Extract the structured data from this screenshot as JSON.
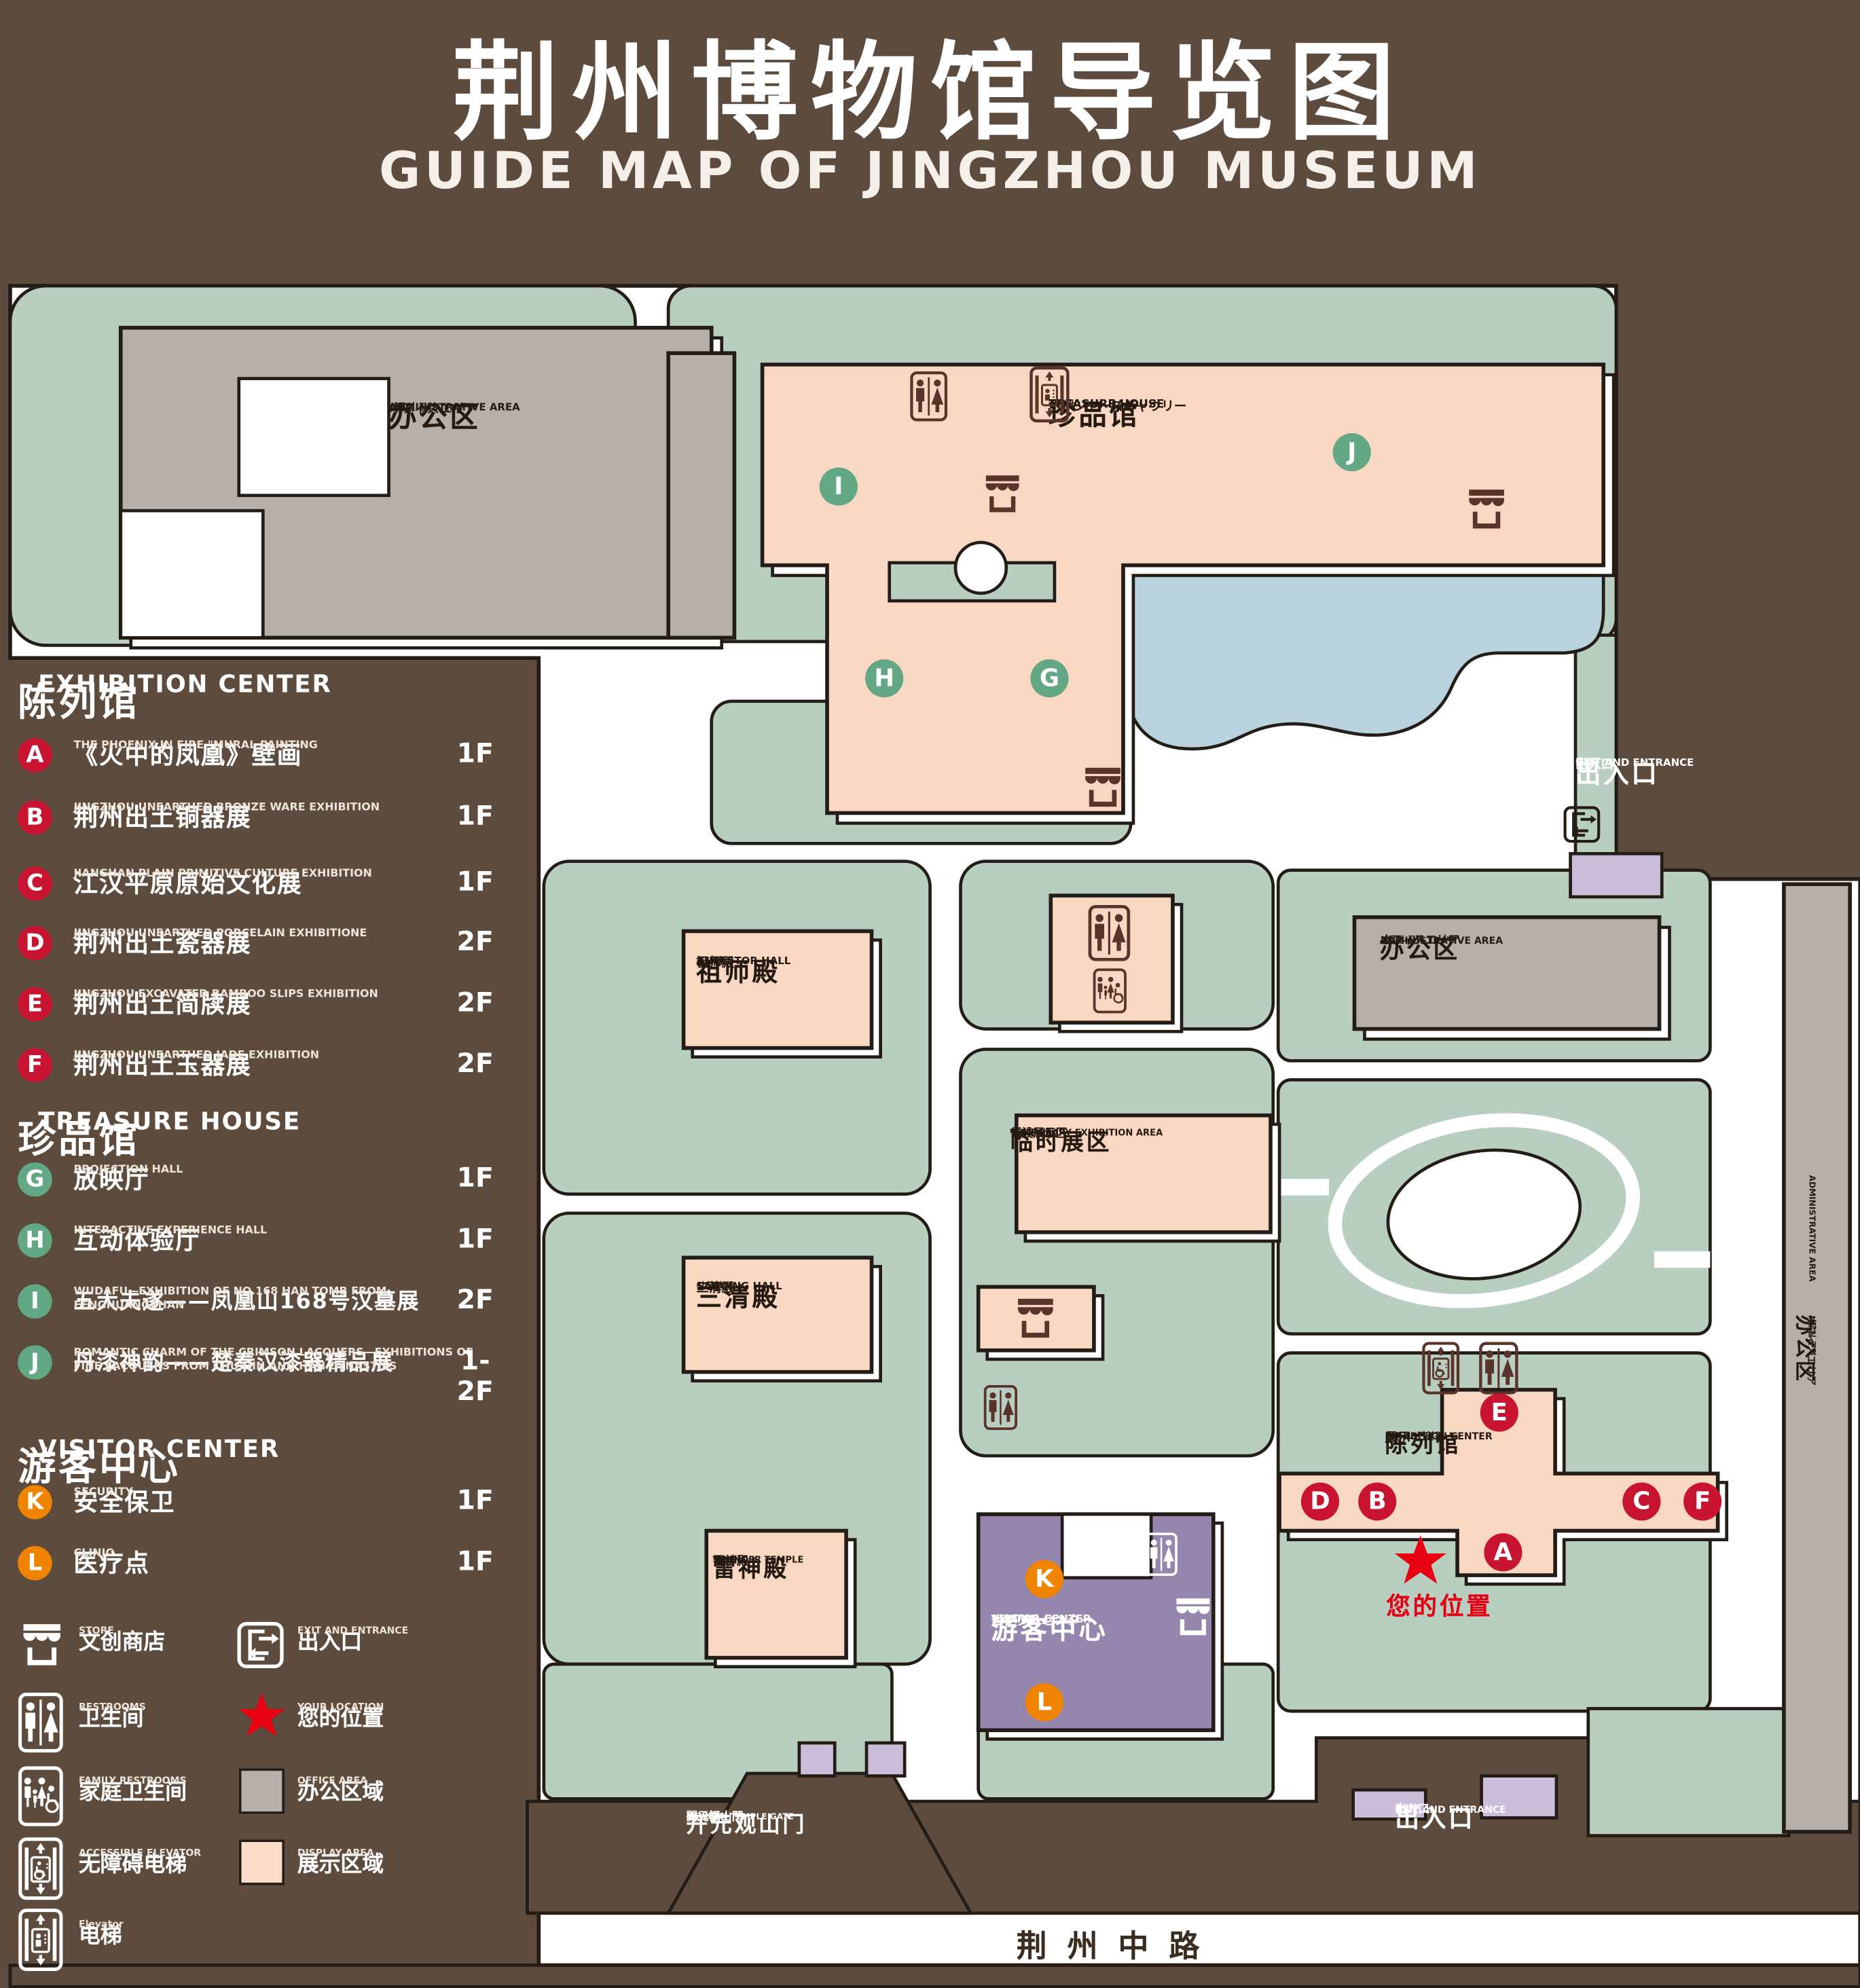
{
  "title": {
    "zh": "荆州博物馆导览图",
    "en": "GUIDE MAP OF JINGZHOU MUSEUM"
  },
  "legend": {
    "sections": [
      {
        "zh": "陈列馆",
        "en": "EXHIBITION CENTER",
        "items": [
          {
            "letter": "A",
            "title": "《火中的凤凰》壁画",
            "sub": "THE PHOENIX IN FIRE \"MURAL PAINTING",
            "floor": "1F"
          },
          {
            "letter": "B",
            "title": "荆州出土铜器展",
            "sub": "JINGZHOU UNEARTHED BRONZE WARE EXHIBITION",
            "floor": "1F"
          },
          {
            "letter": "C",
            "title": "江汉平原原始文化展",
            "sub": "JIANGHAN PLAIN PRIMITIVE CULTURE EXHIBITION",
            "floor": "1F"
          },
          {
            "letter": "D",
            "title": "荆州出土瓷器展",
            "sub": "JINGZHOU UNEARTHED PORCELAIN EXHIBITIONE",
            "floor": "2F"
          },
          {
            "letter": "E",
            "title": "荆州出土简牍展",
            "sub": "JINGZHOU EXCAVATED BAMBOO SLIPS EXHIBITION",
            "floor": "2F"
          },
          {
            "letter": "F",
            "title": "荆州出土玉器展",
            "sub": "JINGZHOU UNEARTHED JADE EXHIBITION",
            "floor": "2F"
          }
        ]
      },
      {
        "zh": "珍品馆",
        "en": "TREASURE HOUSE",
        "items": [
          {
            "letter": "G",
            "title": "放映厅",
            "sub": "PROJECTION HALL",
            "floor": "1F"
          },
          {
            "letter": "H",
            "title": "互动体验厅",
            "sub": "INTERACTIVE EXPERIENCE HALL",
            "floor": "1F"
          },
          {
            "letter": "I",
            "title": "五大夫遂——凤凰山168号汉墓展",
            "sub": "WUDAFU—EXHIBITION OF NO.168 HAN TOMB FROM FENGHUANGSHAN",
            "floor": "2F"
          },
          {
            "letter": "J",
            "title": "丹漆神韵——楚秦汉漆器精品展",
            "sub": "ROMANTIC CHARM OF THE CRIMSON LACQUERS—EXHIBITIONS OF FINE LACQUERS FROM CHU,QIN AND HAN DYNASTIES",
            "floor": "1-2F"
          }
        ]
      },
      {
        "zh": "游客中心",
        "en": "VISITOR CENTER",
        "items": [
          {
            "letter": "K",
            "title": "安全保卫",
            "sub": "SECURITY",
            "floor": "1F"
          },
          {
            "letter": "L",
            "title": "医疗点",
            "sub": "CLINIC",
            "floor": "1F"
          }
        ]
      }
    ],
    "symbols": [
      {
        "zh": "文创商店",
        "en": "STORE"
      },
      {
        "zh": "出入口",
        "en": "EXIT AND ENTRANCE"
      },
      {
        "zh": "卫生间",
        "en": "RESTROOMS"
      },
      {
        "zh": "您的位置",
        "en": "YOUR LOCATION"
      },
      {
        "zh": "家庭卫生间",
        "en": "FAMILY RESTROOMS"
      },
      {
        "zh": "办公区域",
        "en": "OFFICE AREA"
      },
      {
        "zh": "无障碍电梯",
        "en": "ACCESSIBLE ELEVATOR"
      },
      {
        "zh": "展示区域",
        "en": "DISPLAY AREA"
      },
      {
        "zh": "电梯",
        "en": "Elevator"
      }
    ]
  },
  "map": {
    "buildings": {
      "admin_nw": {
        "zh": "办公区",
        "en": "ADMINISTRATIVE AREA",
        "jp": "オフィスエリア",
        "kr": "사무실 구역"
      },
      "admin_e": {
        "zh": "办公区",
        "en": "ADMINISTRATIVE AREA",
        "jp": "オフィスエリア",
        "kr": "사무실 구역"
      },
      "admin_strip": {
        "zh": "办公区",
        "en": "ADMINISTRATIVE AREA",
        "jp": "オフィスエリア",
        "kr": "사무실 구역"
      },
      "treasure": {
        "zh": "珍品馆",
        "en": "TREASURE HOUSE",
        "jp": "トレジャーズギャウリー",
        "kr": "진품관"
      },
      "ancestor": {
        "zh": "祖师殿",
        "en": "ANCESTOR HALL",
        "jp": "祖师殿",
        "kr": "조사전"
      },
      "sanqing": {
        "zh": "三清殿",
        "en": "SANQING HALL",
        "jp": "三清殿",
        "kr": "삼청전"
      },
      "thunder": {
        "zh": "雷神殿",
        "en": "THUNDER TEMPLE",
        "jp": "雷神殿",
        "kr": "뇌신전"
      },
      "temporary": {
        "zh": "临时展区",
        "en": "TEMPORARY EXHIBITION AREA",
        "jp": "仮設展示区",
        "kr": "임시 전시실"
      },
      "visitor": {
        "zh": "游客中心",
        "en": "VISITOR CENTER",
        "jp": "ビジターセンター",
        "kr": "관광객 센터"
      },
      "exhibition": {
        "zh": "陈列馆",
        "en": "EXHIBITION CENTER",
        "jp": "展示",
        "kr": "ホール 진열관"
      },
      "gate": {
        "zh": "开元观山门",
        "en": "KAIYUAN TEMPLE GATE",
        "jp": "開元観山門",
        "kr": "산문을 열다"
      },
      "exit_ne": {
        "zh": "出入口",
        "en": "EXIT AND ENTRANCE",
        "jp": "出入口",
        "kr": "출입구"
      },
      "exit_s": {
        "zh": "出入口",
        "en": "EXIT AND ENTRANCE",
        "jp": "出入口",
        "kr": "출입구"
      }
    },
    "road": "荆州中路",
    "your_location": "您的位置",
    "markers": [
      {
        "letter": "A",
        "area": "exhibition"
      },
      {
        "letter": "B",
        "area": "exhibition"
      },
      {
        "letter": "C",
        "area": "exhibition"
      },
      {
        "letter": "D",
        "area": "exhibition"
      },
      {
        "letter": "E",
        "area": "exhibition"
      },
      {
        "letter": "F",
        "area": "exhibition"
      },
      {
        "letter": "G",
        "area": "treasure"
      },
      {
        "letter": "H",
        "area": "treasure"
      },
      {
        "letter": "I",
        "area": "treasure"
      },
      {
        "letter": "J",
        "area": "treasure"
      },
      {
        "letter": "K",
        "area": "visitor"
      },
      {
        "letter": "L",
        "area": "visitor"
      }
    ],
    "colors": {
      "background": "#5d4b3e",
      "green_area": "#b7cec1",
      "display_area": "#f8d8c3",
      "office_area": "#b5b0ac",
      "visitor_center": "#9586ae",
      "lake": "#b9d3de",
      "gate_purple": "#cabdd9",
      "marker_red": "#c81430",
      "marker_green": "#63a885",
      "marker_orange": "#f08300",
      "location_red": "#e60012",
      "outline": "#241c16"
    }
  }
}
